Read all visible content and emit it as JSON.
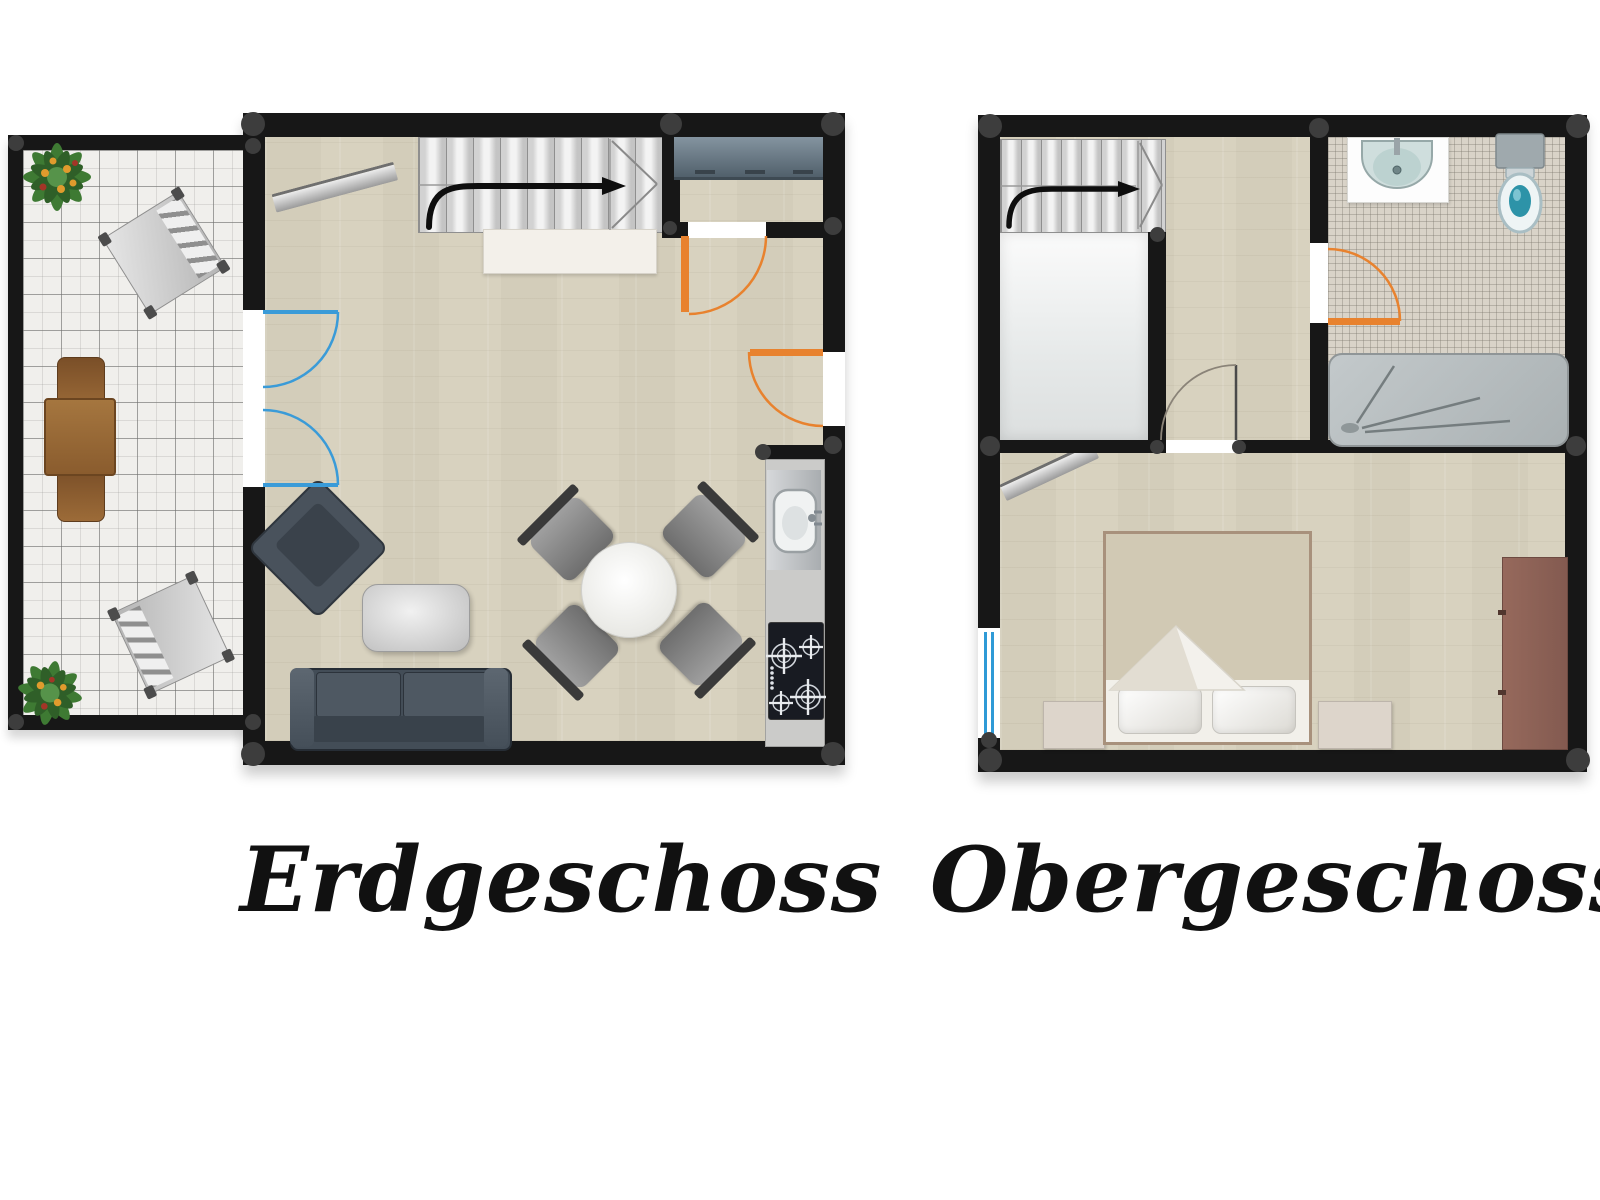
{
  "floors": [
    {
      "label": "Erdgeschoss",
      "areas": [
        "terrace",
        "living-room",
        "entrance-area",
        "kitchen-line"
      ],
      "furniture": [
        "potted-plant",
        "garden-chair",
        "garden-table",
        "garden-chairs",
        "staircase-up",
        "console-table",
        "wall-shelf",
        "sideboard",
        "sofa",
        "coffee-table",
        "armchair",
        "round-dining-table",
        "dining-chairs-x4",
        "kitchen-sink",
        "cooktop"
      ],
      "doors": [
        {
          "name": "terrace-french-door",
          "color": "#3a9bd8"
        },
        {
          "name": "interior-door",
          "color": "#e8822e"
        },
        {
          "name": "entry-door",
          "color": "#e8822e"
        }
      ]
    },
    {
      "label": "Obergeschoss",
      "areas": [
        "stairwell",
        "landing",
        "bathroom",
        "bedroom"
      ],
      "furniture": [
        "staircase-up",
        "wash-basin",
        "toilet",
        "shower",
        "wall-shelf",
        "double-bed",
        "pillows-x2",
        "nightstands-x2",
        "wardrobe"
      ],
      "doors": [
        {
          "name": "bathroom-door",
          "color": "#e8822e"
        },
        {
          "name": "bedroom-door",
          "color": "#8a8378"
        },
        {
          "name": "bedroom-window",
          "color": "#2f9ad6"
        }
      ]
    }
  ],
  "palette": {
    "wall": "#171717",
    "wood_floor": "#d8d2bf",
    "tile_floor": "#f0efec",
    "mosaic_floor": "#d9d3c8",
    "stairs": "#d9d9d9",
    "accent_orange": "#e8822e",
    "accent_blue": "#3a9bd8",
    "label_color": "#111111"
  }
}
